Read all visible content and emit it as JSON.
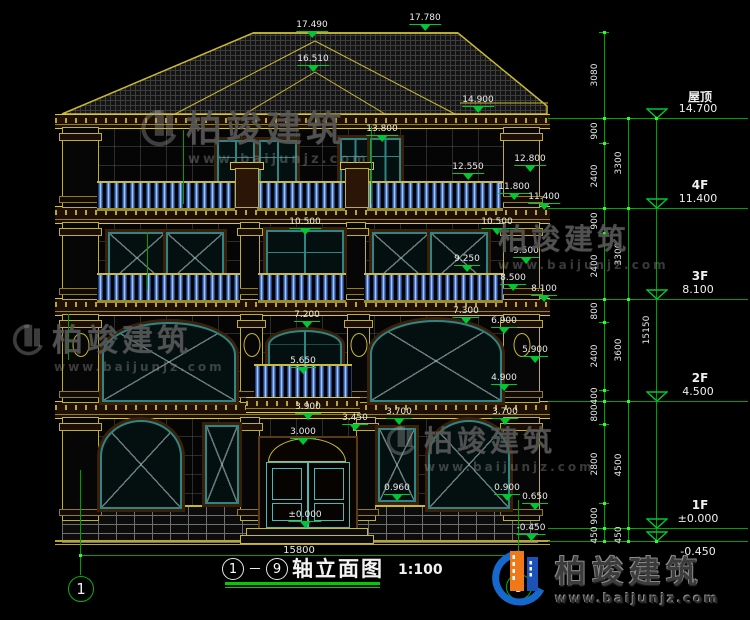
{
  "watermark": {
    "cn": "柏竣建筑",
    "url": "www.baijunjz.com"
  },
  "brand": {
    "cn": "柏竣建筑",
    "url": "www.baijunjz.com"
  },
  "title_block": {
    "axis_start": "1",
    "axis_end": "9",
    "dash": "—",
    "name": "轴立面图",
    "scale": "1:100"
  },
  "bottom_dimension": "15800",
  "axis_bubbles": [
    {
      "n": "1"
    },
    {
      "n": "9"
    }
  ],
  "colors": {
    "dim_green": "#00b400",
    "cad_yellow": "#c8b832",
    "teal": "#2f8585",
    "baluster_blue": "#4a7cd0"
  },
  "elevation_markers": [
    {
      "v": "17.490",
      "x": 312,
      "y": 21
    },
    {
      "v": "17.780",
      "x": 425,
      "y": 14
    },
    {
      "v": "16.510",
      "x": 313,
      "y": 55
    },
    {
      "v": "14.900",
      "x": 478,
      "y": 96
    },
    {
      "v": "13.800",
      "x": 382,
      "y": 125
    },
    {
      "v": "12.800",
      "x": 530,
      "y": 155
    },
    {
      "v": "12.550",
      "x": 468,
      "y": 163
    },
    {
      "v": "11.800",
      "x": 514,
      "y": 183
    },
    {
      "v": "11.400",
      "x": 544,
      "y": 193
    },
    {
      "v": "10.500",
      "x": 305,
      "y": 218
    },
    {
      "v": "10.500",
      "x": 497,
      "y": 218
    },
    {
      "v": "9.500",
      "x": 526,
      "y": 247
    },
    {
      "v": "9.250",
      "x": 467,
      "y": 255
    },
    {
      "v": "8.500",
      "x": 513,
      "y": 274
    },
    {
      "v": "8.100",
      "x": 544,
      "y": 285
    },
    {
      "v": "7.300",
      "x": 466,
      "y": 307
    },
    {
      "v": "7.200",
      "x": 307,
      "y": 311
    },
    {
      "v": "6.900",
      "x": 504,
      "y": 317
    },
    {
      "v": "5.900",
      "x": 535,
      "y": 346
    },
    {
      "v": "5.650",
      "x": 303,
      "y": 357
    },
    {
      "v": "4.900",
      "x": 504,
      "y": 374
    },
    {
      "v": "3.900",
      "x": 308,
      "y": 403
    },
    {
      "v": "3.700",
      "x": 399,
      "y": 408
    },
    {
      "v": "3.700",
      "x": 505,
      "y": 408
    },
    {
      "v": "3.450",
      "x": 355,
      "y": 414
    },
    {
      "v": "3.000",
      "x": 303,
      "y": 428
    },
    {
      "v": "0.960",
      "x": 397,
      "y": 484
    },
    {
      "v": "0.900",
      "x": 507,
      "y": 484
    },
    {
      "v": "0.650",
      "x": 535,
      "y": 493
    },
    {
      "v": "±0.000",
      "x": 305,
      "y": 511
    },
    {
      "v": "-0.450",
      "x": 531,
      "y": 524
    }
  ],
  "floor_levels": [
    {
      "name": "屋顶",
      "value": "14.700",
      "y": 118,
      "below": false
    },
    {
      "name": "4F",
      "value": "11.400",
      "y": 208,
      "below": false
    },
    {
      "name": "3F",
      "value": "8.100",
      "y": 299,
      "below": false
    },
    {
      "name": "2F",
      "value": "4.500",
      "y": 401,
      "below": false
    },
    {
      "name": "1F",
      "value": "±0.000",
      "y": 528,
      "below": false
    },
    {
      "name": "",
      "value": "-0.450",
      "y": 541,
      "below": true
    }
  ],
  "dim_chains": {
    "chain_a": {
      "x": 604,
      "segments": [
        {
          "v": "3080",
          "y1": 32,
          "y2": 118
        },
        {
          "v": "900",
          "y1": 118,
          "y2": 143
        },
        {
          "v": "2400",
          "y1": 143,
          "y2": 208
        },
        {
          "v": "900",
          "y1": 208,
          "y2": 233
        },
        {
          "v": "2400",
          "y1": 233,
          "y2": 299
        },
        {
          "v": "800",
          "y1": 299,
          "y2": 322
        },
        {
          "v": "2400",
          "y1": 322,
          "y2": 390
        },
        {
          "v": "400",
          "y1": 390,
          "y2": 401
        },
        {
          "v": "800",
          "y1": 401,
          "y2": 424
        },
        {
          "v": "2800",
          "y1": 424,
          "y2": 503
        },
        {
          "v": "900",
          "y1": 503,
          "y2": 528
        },
        {
          "v": "450",
          "y1": 528,
          "y2": 541
        }
      ]
    },
    "chain_b": {
      "x": 628,
      "segments": [
        {
          "v": "3300",
          "y1": 118,
          "y2": 208
        },
        {
          "v": "3300",
          "y1": 208,
          "y2": 299
        },
        {
          "v": "3600",
          "y1": 299,
          "y2": 401
        },
        {
          "v": "4500",
          "y1": 401,
          "y2": 528
        },
        {
          "v": "450",
          "y1": 528,
          "y2": 541
        }
      ]
    },
    "overall": {
      "x": 656,
      "segments": [
        {
          "v": "15150",
          "y1": 118,
          "y2": 541
        }
      ]
    }
  }
}
